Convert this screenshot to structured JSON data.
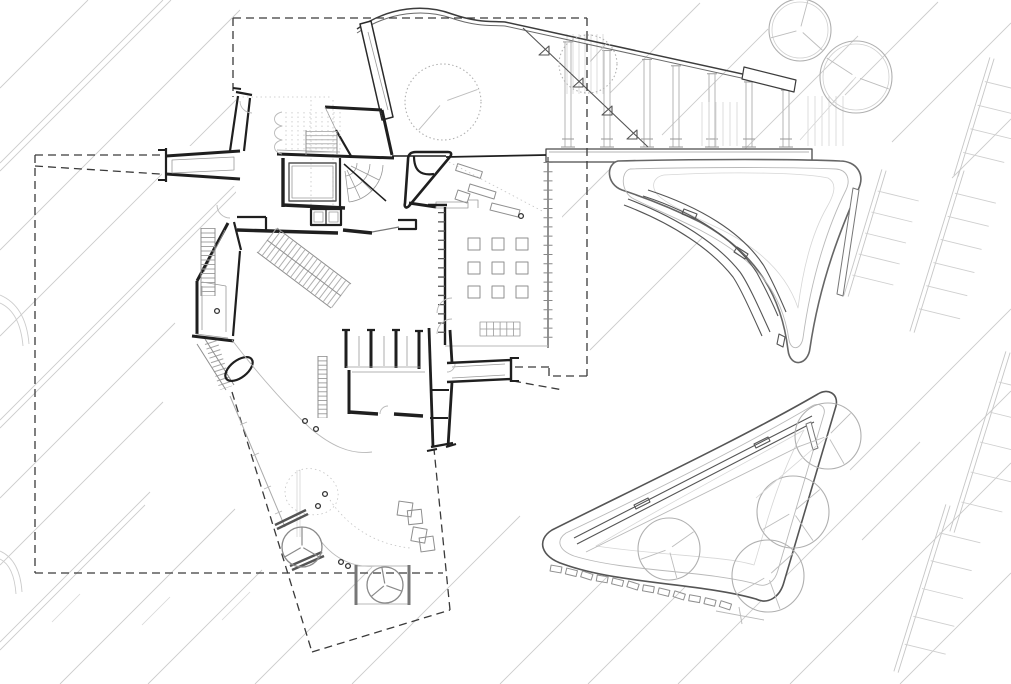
{
  "document": {
    "title": "Architectural site plan - ground floor line drawing",
    "type": "black-and-white CAD site plan",
    "visible_text": "none"
  },
  "canvas": {
    "width": 1011,
    "height": 684
  },
  "palette": {
    "paper": "#ffffff",
    "ink": "#1f1f1f",
    "dark": "#555555",
    "medium": "#8f8f8f",
    "light": "#b9b9b9",
    "faint": "#d6d6d6",
    "road": "#cccccc",
    "dash": "#3a3a3a"
  },
  "features": {
    "trees": [
      {
        "cx": 443,
        "cy": 102,
        "r": 38,
        "dotted": true,
        "double": false,
        "spokes": [
          -20,
          131
        ]
      },
      {
        "cx": 588,
        "cy": 64,
        "r": 29,
        "dotted": true,
        "double": false,
        "spokes": [
          -48
        ]
      },
      {
        "cx": 800,
        "cy": 30,
        "r": 31,
        "dotted": false,
        "double": true,
        "spokes": [
          42,
          165,
          -75
        ]
      },
      {
        "cx": 856,
        "cy": 77,
        "r": 36,
        "dotted": false,
        "double": true,
        "spokes": [
          132,
          213,
          20
        ]
      },
      {
        "cx": 828,
        "cy": 436,
        "r": 33,
        "dotted": false,
        "double": false,
        "spokes": [
          -45,
          160,
          60
        ]
      },
      {
        "cx": 793,
        "cy": 512,
        "r": 36,
        "dotted": false,
        "double": false,
        "spokes": [
          -40,
          150,
          55
        ]
      },
      {
        "cx": 669,
        "cy": 549,
        "r": 31,
        "dotted": false,
        "double": false,
        "spokes": [
          -35,
          160,
          75
        ]
      },
      {
        "cx": 768,
        "cy": 576,
        "r": 36,
        "dotted": false,
        "double": false,
        "spokes": [
          -42,
          150,
          70
        ]
      }
    ],
    "fan_trees": [
      {
        "cx": 302,
        "cy": 547,
        "r": 20,
        "spokes": [
          30,
          150,
          270
        ]
      },
      {
        "cx": 385,
        "cy": 585,
        "r": 18,
        "spokes": [
          20,
          140,
          260
        ]
      }
    ],
    "survey_markers": [
      [
        305,
        421
      ],
      [
        316,
        429
      ],
      [
        318,
        506
      ],
      [
        325,
        494
      ],
      [
        341,
        562
      ],
      [
        348,
        566
      ],
      [
        521,
        216
      ],
      [
        217,
        311
      ]
    ],
    "pavers": {
      "start": [
        556,
        569
      ],
      "step": [
        15.4,
        3.3
      ],
      "count": 12,
      "size": [
        11,
        6
      ],
      "base_rotation": 14
    },
    "pedestals": {
      "xs": [
        468,
        492,
        516
      ],
      "ys": [
        238,
        262,
        286
      ],
      "size": 12
    },
    "colonnade": {
      "xs": [
        568,
        607,
        647,
        676,
        712,
        749,
        786
      ],
      "base_y": 147,
      "ramp": {
        "x1": 505,
        "y1": 22,
        "x2": 790,
        "y2": 85
      }
    },
    "parking_rakes": [
      {
        "x1": 884,
        "y1": 170,
        "x2": 846,
        "y2": 296,
        "ticks": 5
      },
      {
        "x1": 962,
        "y1": 170,
        "x2": 912,
        "y2": 332,
        "ticks": 6
      },
      {
        "x1": 1008,
        "y1": 352,
        "x2": 952,
        "y2": 532,
        "ticks": 5
      },
      {
        "x1": 948,
        "y1": 505,
        "x2": 896,
        "y2": 672,
        "ticks": 5
      },
      {
        "x1": 992,
        "y1": 58,
        "x2": 956,
        "y2": 176,
        "ticks": 4
      }
    ],
    "stipple": {
      "x": 378,
      "y": 36,
      "w": 26,
      "h": 56,
      "count": 30
    }
  }
}
